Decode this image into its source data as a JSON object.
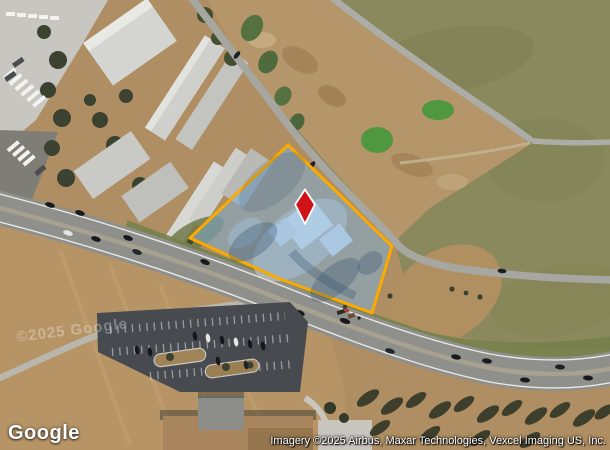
{
  "page": {
    "width": 610,
    "height": 450
  },
  "map": {
    "logo_text": "Google",
    "attribution": "Imagery ©2025 Airbus, Maxar Technologies, Vexcel Imaging US, Inc.",
    "watermark": "©2025 Google",
    "colors": {
      "parcel_outline": "#FBAB00",
      "parcel_fill": "rgba(125,175,220,0.52)",
      "marker_red": "#D01217",
      "marker_outline": "#FFFFFF"
    },
    "parcel": {
      "points": "288,145 316,172 344,199 369,224 392,246 372,313 280,279 190,238"
    },
    "marker": {
      "path": "M305 189.5 L314.8 204.5 L305 224 L295.2 204.5 Z",
      "x": 305,
      "y": 207
    }
  }
}
